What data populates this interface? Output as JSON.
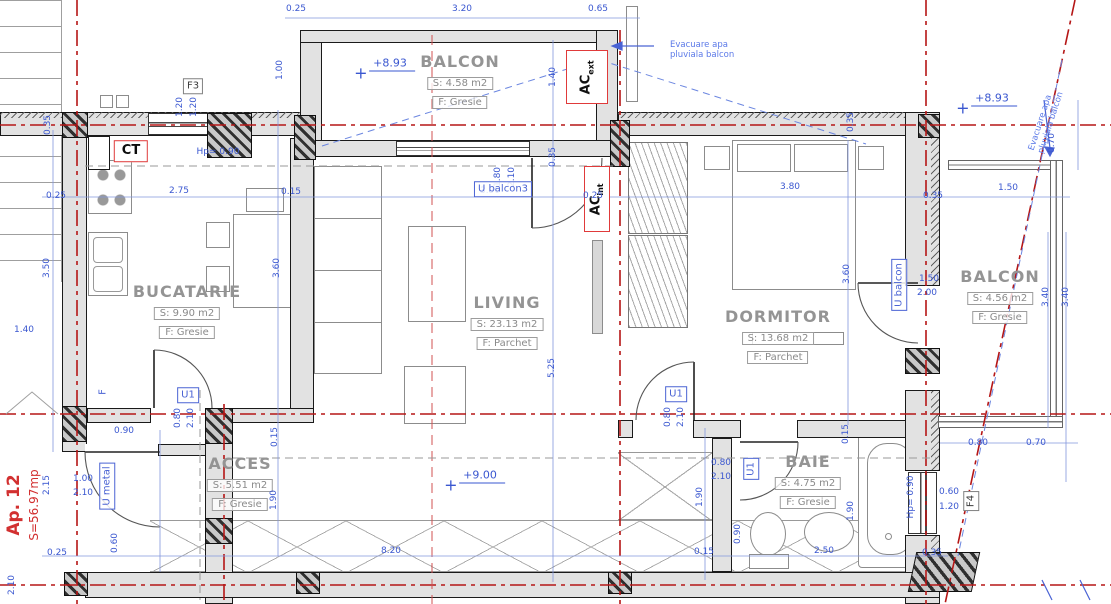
{
  "meta": {
    "drawing_type": "apartment floor plan",
    "palette": {
      "wall_fill": "#e2e2e2",
      "outline": "#1a1a1a",
      "centerline_red": "#b51616",
      "axis_red_light": "#d05050",
      "dim_blue": "#3a57d0",
      "tag_red": "#e03a3a",
      "label_gray": "#949494"
    }
  },
  "apartment": {
    "id": "Ap. 12",
    "total_area": "S=56.97mp"
  },
  "rooms": [
    {
      "name": "BALCON",
      "area": "S: 4.58 m2",
      "finish": "F: Gresie",
      "x": 460,
      "y": 52
    },
    {
      "name": "BUCATARIE",
      "area": "S: 9.90 m2",
      "finish": "F: Gresie",
      "x": 187,
      "y": 282
    },
    {
      "name": "LIVING",
      "area": "S: 23.13 m2",
      "finish": "F: Parchet",
      "x": 507,
      "y": 293
    },
    {
      "name": "DORMITOR",
      "area": "S: 13.68 m2",
      "finish": "F: Parchet",
      "x": 778,
      "y": 307
    },
    {
      "name": "BALCON",
      "area": "S: 4.56 m2",
      "finish": "F: Gresie",
      "x": 1000,
      "y": 267
    },
    {
      "name": "ACCES",
      "area": "S: 5.51 m2",
      "finish": "F: Gresie",
      "x": 240,
      "y": 454
    },
    {
      "name": "BAIE",
      "area": "S: 4.75 m2",
      "finish": "F: Gresie",
      "x": 808,
      "y": 452
    }
  ],
  "levels": [
    {
      "text": "+8.93",
      "x": 392,
      "y": 63
    },
    {
      "text": "+8.93",
      "x": 994,
      "y": 98
    },
    {
      "text": "+9.00",
      "x": 482,
      "y": 475
    }
  ],
  "tags": [
    {
      "text": "F3",
      "kind": "gray",
      "x": 193,
      "y": 86
    },
    {
      "text": "CT",
      "kind": "red",
      "x": 131,
      "y": 151
    },
    {
      "text": "U balcon3",
      "kind": "blue",
      "x": 503,
      "y": 189
    },
    {
      "text": "U balcon",
      "kind": "blue",
      "x": 899,
      "y": 285,
      "r": -90
    },
    {
      "text": "U metal",
      "kind": "blue",
      "x": 107,
      "y": 486,
      "r": -90
    },
    {
      "text": "U1",
      "kind": "blue",
      "x": 188,
      "y": 395
    },
    {
      "text": "U1",
      "kind": "blue",
      "x": 676,
      "y": 394
    },
    {
      "text": "U1",
      "kind": "blue",
      "x": 751,
      "y": 469,
      "r": -90
    },
    {
      "text": "F4",
      "kind": "gray",
      "x": 971,
      "y": 501,
      "r": -90
    },
    {
      "text": "F",
      "kind": "bluetext",
      "x": 103,
      "y": 392,
      "r": -90
    }
  ],
  "ac": {
    "ext": {
      "main": "AC",
      "sub": "ext"
    },
    "int": {
      "main": "AC",
      "sub": "int"
    }
  },
  "notes": [
    {
      "text": "Evacuare apa pluviala balcon",
      "x": 714,
      "y": 50,
      "w": 88
    },
    {
      "text": "Evacuare apa pluviala balcon",
      "x": 1050,
      "y": 110,
      "w": 88,
      "r": -72
    }
  ],
  "dims": [
    {
      "t": "0.25",
      "x": 296,
      "y": 9
    },
    {
      "t": "3.20",
      "x": 462,
      "y": 9
    },
    {
      "t": "0.65",
      "x": 598,
      "y": 9
    },
    {
      "t": "1.00",
      "x": 280,
      "y": 70,
      "r": -90
    },
    {
      "t": "1.20",
      "x": 180,
      "y": 107,
      "r": -90
    },
    {
      "t": "1.20",
      "x": 194,
      "y": 107,
      "r": -90
    },
    {
      "t": "0.35",
      "x": 48,
      "y": 125,
      "r": -90
    },
    {
      "t": "Hp= 0.90",
      "x": 218,
      "y": 152
    },
    {
      "t": "1.40",
      "x": 553,
      "y": 77,
      "r": -90
    },
    {
      "t": "0.35",
      "x": 553,
      "y": 157,
      "r": -90
    },
    {
      "t": "0.35",
      "x": 851,
      "y": 122,
      "r": -90
    },
    {
      "t": "0.70",
      "x": 1052,
      "y": 143,
      "r": -90
    },
    {
      "t": "0.25",
      "x": 56,
      "y": 196
    },
    {
      "t": "2.75",
      "x": 179,
      "y": 191
    },
    {
      "t": "0.15",
      "x": 291,
      "y": 192
    },
    {
      "t": "3.90",
      "x": 490,
      "y": 191
    },
    {
      "t": "1.80",
      "x": 498,
      "y": 177,
      "r": -90
    },
    {
      "t": "2.10",
      "x": 512,
      "y": 177,
      "r": -90
    },
    {
      "t": "3.80",
      "x": 790,
      "y": 187
    },
    {
      "t": "0.35",
      "x": 933,
      "y": 196
    },
    {
      "t": "1.50",
      "x": 1008,
      "y": 188
    },
    {
      "t": "3.50",
      "x": 47,
      "y": 268,
      "r": -90
    },
    {
      "t": "1.40",
      "x": 24,
      "y": 330
    },
    {
      "t": "3.60",
      "x": 277,
      "y": 268,
      "r": -90
    },
    {
      "t": "5.25",
      "x": 552,
      "y": 368,
      "r": -90
    },
    {
      "t": "3.60",
      "x": 847,
      "y": 274,
      "r": -90
    },
    {
      "t": "1.50",
      "x": 929,
      "y": 279
    },
    {
      "t": "2.00",
      "x": 927,
      "y": 293
    },
    {
      "t": "3.40",
      "x": 1046,
      "y": 297,
      "r": -90
    },
    {
      "t": "3.40",
      "x": 1066,
      "y": 297,
      "r": -90
    },
    {
      "t": "0.80",
      "x": 178,
      "y": 418,
      "r": -90
    },
    {
      "t": "2.10",
      "x": 191,
      "y": 418,
      "r": -90
    },
    {
      "t": "0.80",
      "x": 668,
      "y": 417,
      "r": -90
    },
    {
      "t": "2.10",
      "x": 681,
      "y": 417,
      "r": -90
    },
    {
      "t": "0.15",
      "x": 275,
      "y": 437,
      "r": -90
    },
    {
      "t": "0.15",
      "x": 846,
      "y": 434,
      "r": -90
    },
    {
      "t": "0.90",
      "x": 124,
      "y": 431
    },
    {
      "t": "1.00",
      "x": 83,
      "y": 479
    },
    {
      "t": "2.10",
      "x": 83,
      "y": 493
    },
    {
      "t": "2.15",
      "x": 47,
      "y": 485,
      "r": -90
    },
    {
      "t": "1.90",
      "x": 274,
      "y": 500,
      "r": -90
    },
    {
      "t": "1.90",
      "x": 700,
      "y": 497,
      "r": -90
    },
    {
      "t": "1.90",
      "x": 851,
      "y": 511,
      "r": -90
    },
    {
      "t": "0.80",
      "x": 721,
      "y": 463
    },
    {
      "t": "2.10",
      "x": 721,
      "y": 477
    },
    {
      "t": "0.90",
      "x": 738,
      "y": 534,
      "r": -90
    },
    {
      "t": "Hp= 0.90",
      "x": 911,
      "y": 497,
      "r": -90
    },
    {
      "t": "0.60",
      "x": 949,
      "y": 492
    },
    {
      "t": "1.20",
      "x": 949,
      "y": 507
    },
    {
      "t": "0.80",
      "x": 978,
      "y": 443
    },
    {
      "t": "0.70",
      "x": 1036,
      "y": 443
    },
    {
      "t": "0.25",
      "x": 593,
      "y": 196
    },
    {
      "t": "0.25",
      "x": 57,
      "y": 553
    },
    {
      "t": "0.60",
      "x": 115,
      "y": 543,
      "r": -90
    },
    {
      "t": "2.10",
      "x": 12,
      "y": 585,
      "r": -90
    },
    {
      "t": "8.20",
      "x": 391,
      "y": 551
    },
    {
      "t": "0.15",
      "x": 704,
      "y": 552
    },
    {
      "t": "2.50",
      "x": 824,
      "y": 551
    },
    {
      "t": "0.35",
      "x": 932,
      "y": 553
    }
  ]
}
